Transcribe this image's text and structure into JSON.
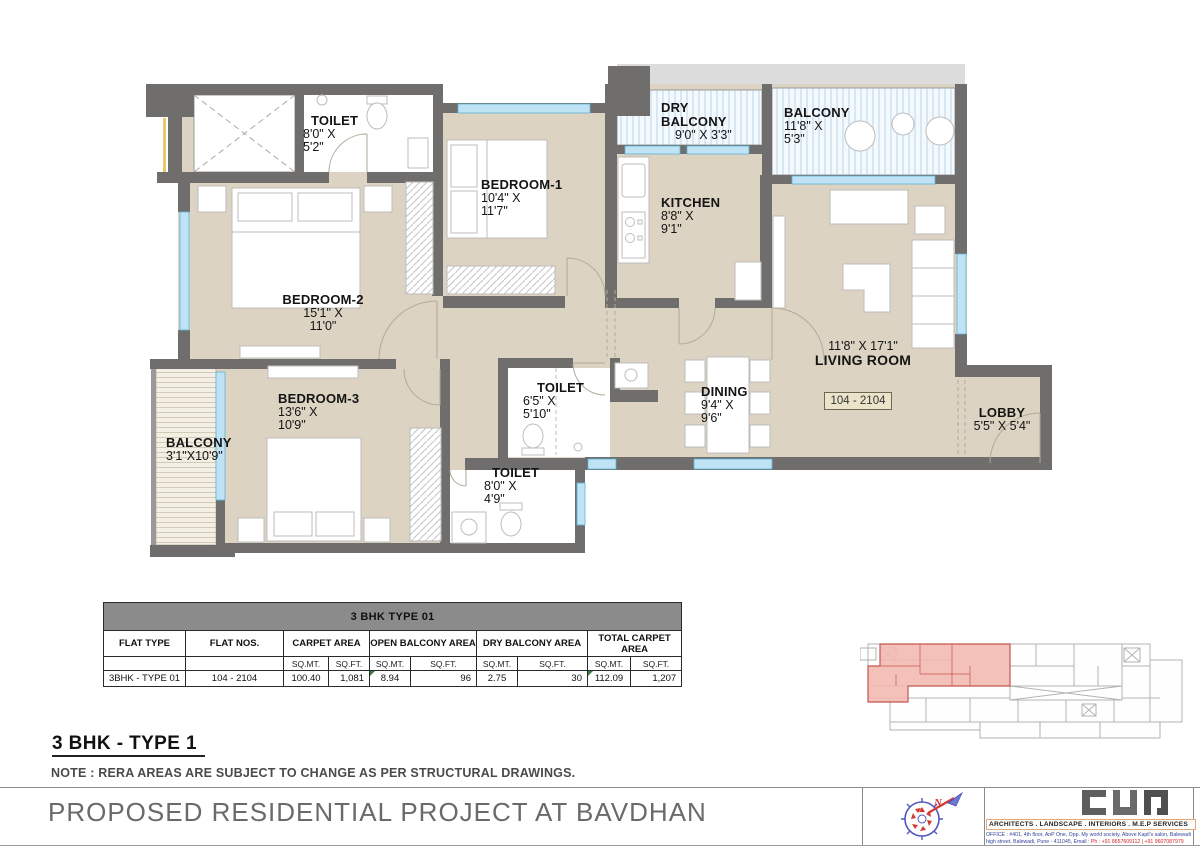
{
  "plan": {
    "labels": {
      "toilet_top": {
        "name": "TOILET",
        "dim1": "8'0\" X",
        "dim2": "5'2\""
      },
      "bedroom1": {
        "name": "BEDROOM-1",
        "dim1": "10'4\" X",
        "dim2": "11'7\""
      },
      "dry_balcony": {
        "name1": "DRY",
        "name2": "BALCONY",
        "dim1": "9'0\" X 3'3\""
      },
      "balcony_tr": {
        "name": "BALCONY",
        "dim1": "11'8\" X",
        "dim2": "5'3\""
      },
      "kitchen": {
        "name": "KITCHEN",
        "dim1": "8'8\" X",
        "dim2": "9'1\""
      },
      "bedroom2": {
        "name": "BEDROOM-2",
        "dim1": "15'1\" X",
        "dim2": "11'0\""
      },
      "bedroom3": {
        "name": "BEDROOM-3",
        "dim1": "13'6\" X",
        "dim2": "10'9\""
      },
      "balcony_left": {
        "name": "BALCONY",
        "dim1": "3'1\"X10'9\""
      },
      "toilet_mid": {
        "name": "TOILET",
        "dim1": "6'5\" X",
        "dim2": "5'10\""
      },
      "toilet_bottom": {
        "name": "TOILET",
        "dim1": "8'0\" X",
        "dim2": "4'9\""
      },
      "dining": {
        "name": "DINING",
        "dim1": "9'4\" X",
        "dim2": "9'6\""
      },
      "living": {
        "dims": "11'8\" X 17'1\"",
        "name": "LIVING ROOM"
      },
      "lobby": {
        "name": "LOBBY",
        "dim1": "5'5\" X 5'4\""
      },
      "unit_range": "104 - 2104"
    }
  },
  "table": {
    "title": "3 BHK TYPE 01",
    "col_flat_type": "FLAT TYPE",
    "col_flat_nos": "FLAT NOS.",
    "col_carpet": "CARPET AREA",
    "col_open_balcony": "OPEN BALCONY AREA",
    "col_dry_balcony": "DRY BALCONY AREA",
    "col_total": "TOTAL CARPET AREA",
    "sqmt": "SQ.MT.",
    "sqft": "SQ.FT.",
    "row": {
      "flat_type": "3BHK - TYPE 01",
      "flat_nos": "104 - 2104",
      "carpet_sqmt": "100.40",
      "carpet_sqft": "1,081",
      "open_sqmt": "8.94",
      "open_sqft": "96",
      "dry_sqmt": "2.75",
      "dry_sqft": "30",
      "total_sqmt": "112.09",
      "total_sqft": "1,207"
    }
  },
  "headings": {
    "type_title": "3 BHK - TYPE 1",
    "note": "NOTE : RERA AREAS ARE SUBJECT TO CHANGE AS PER STRUCTURAL DRAWINGS."
  },
  "footer": {
    "project_title": "PROPOSED RESIDENTIAL PROJECT AT BAVDHAN",
    "services": "ARCHITECTS .  LANDSCAPE .  INTERIORS .   M.E.P  SERVICES",
    "address_line1": "OFFICE : #401, 4th floor, AnP One, Opp. My world society, Above Kapil's salon, Balewadi high street, Balewadi,",
    "address_line2": "Pune - 411045, Email :",
    "phone": "Ph : +91 8657609112  |  +91 9607087979"
  }
}
